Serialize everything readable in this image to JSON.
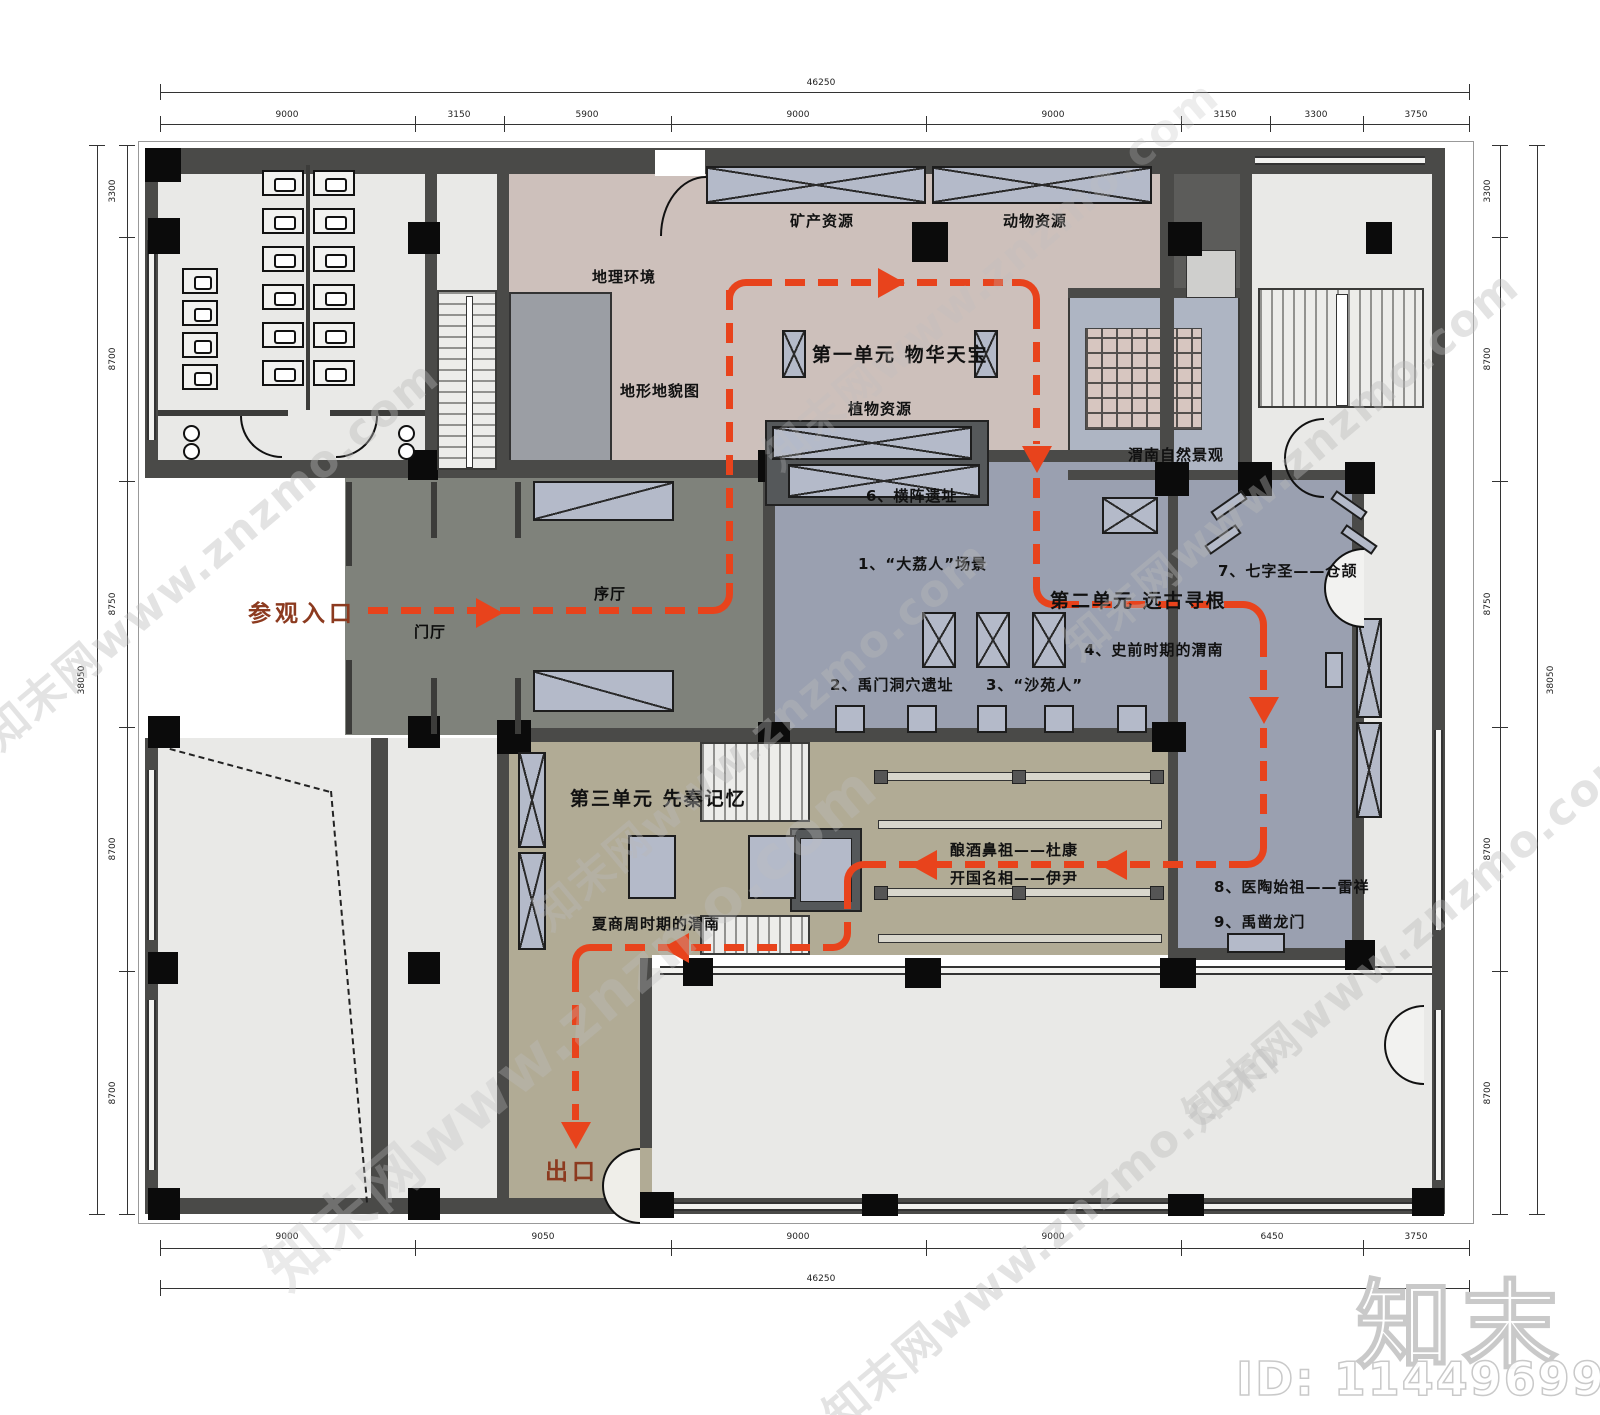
{
  "labels": {
    "mineral": "矿产资源",
    "animal": "动物资源",
    "geo_env": "地理环境",
    "terrain_map": "地形地貌图",
    "unit1_title": "第一单元 物华天宝",
    "plant": "植物资源",
    "natural_view": "渭南自然景观",
    "hengzhen": "6、横阵遗址",
    "dali": "1、“大荔人”场景",
    "qizisheng": "7、七字圣——仓颉",
    "unit2_title": "第二单元 远古寻根",
    "prehistoric": "4、史前时期的渭南",
    "yumen": "2、禹门洞穴遗址",
    "shayuan": "3、“沙苑人”",
    "xuting": "序厅",
    "menting": "门厅",
    "entrance": "参观入口",
    "unit3_title": "第三单元 先秦记忆",
    "xiashangzhou": "夏商周时期的渭南",
    "niangjiu": "酿酒鼻祖——杜康",
    "kaiguo": "开国名相——伊尹",
    "yitao": "8、医陶始祖——雷祥",
    "yuzao": "9、禹凿龙门",
    "exit": "出口"
  },
  "dims": {
    "top": {
      "total": "46250",
      "segments": [
        "9000",
        "3150",
        "5900",
        "9000",
        "9000",
        "3150",
        "3300",
        "3750"
      ]
    },
    "bottom": {
      "total": "46250",
      "segments": [
        "9000",
        "9050",
        "9000",
        "9000",
        "6450",
        "3750"
      ]
    },
    "left": {
      "total": "38050",
      "segments": [
        "3300",
        "8700",
        "8750",
        "8700",
        "8700"
      ]
    },
    "right": {
      "total": "38050",
      "segments": [
        "3300",
        "8700",
        "8750",
        "8700",
        "8700"
      ]
    }
  },
  "watermark": {
    "text": "知末网www.znzmo.com",
    "logo": "知末",
    "id_text": "ID: 1144969903"
  },
  "colors": {
    "unit1_zone": "#cdc0bb",
    "unit2_zone": "#9aa0b0",
    "natural_view_zone": "#aeb5c3",
    "hall_zone": "#7f827b",
    "unit3_zone": "#b1ab95",
    "room": "#e9e9e7",
    "wall": "#4a4a48",
    "display_case": "#b4bac9",
    "grid_platform": "#d7c6c0",
    "route": "#e8431c",
    "route_label": "#8c3a1f"
  }
}
